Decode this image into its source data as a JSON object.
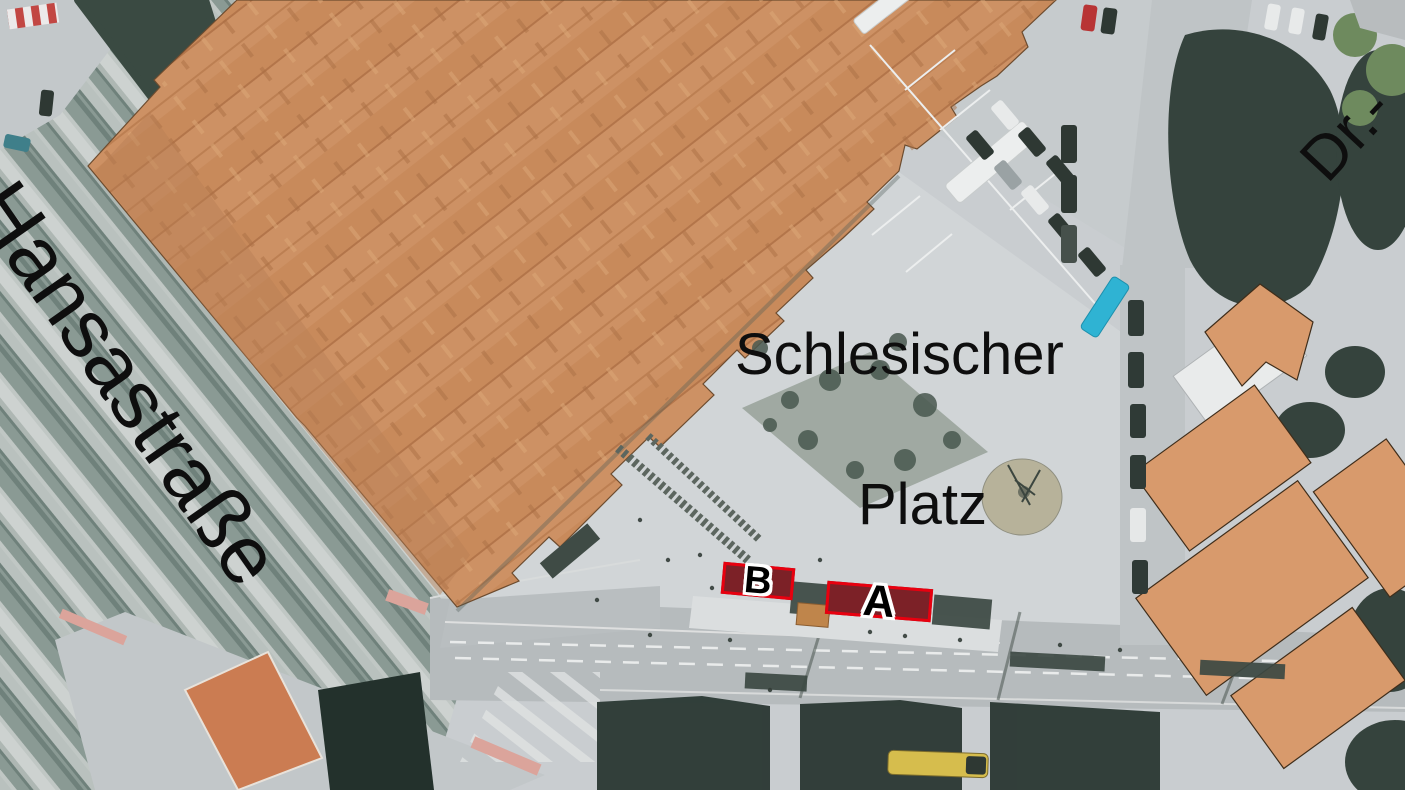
{
  "map": {
    "type": "aerial-imagery-with-annotations",
    "place": "Schlesischer Platz",
    "labels": {
      "street_left": "Hansastraße",
      "place_line1": "Schlesischer",
      "place_line2": "Platz",
      "street_top_right": "Dr.-"
    },
    "stops": [
      {
        "label": "A"
      },
      {
        "label": "B"
      }
    ],
    "colors": {
      "station_overlay": "#cd9164",
      "building_overlay": "#d89a6c",
      "stop_fill": "#7c2127",
      "stop_border": "#e8000f",
      "label_text": "#0e0e0e",
      "bus_cyan": "#2fb3d3",
      "tram_yellow": "#d6bd4d"
    }
  }
}
